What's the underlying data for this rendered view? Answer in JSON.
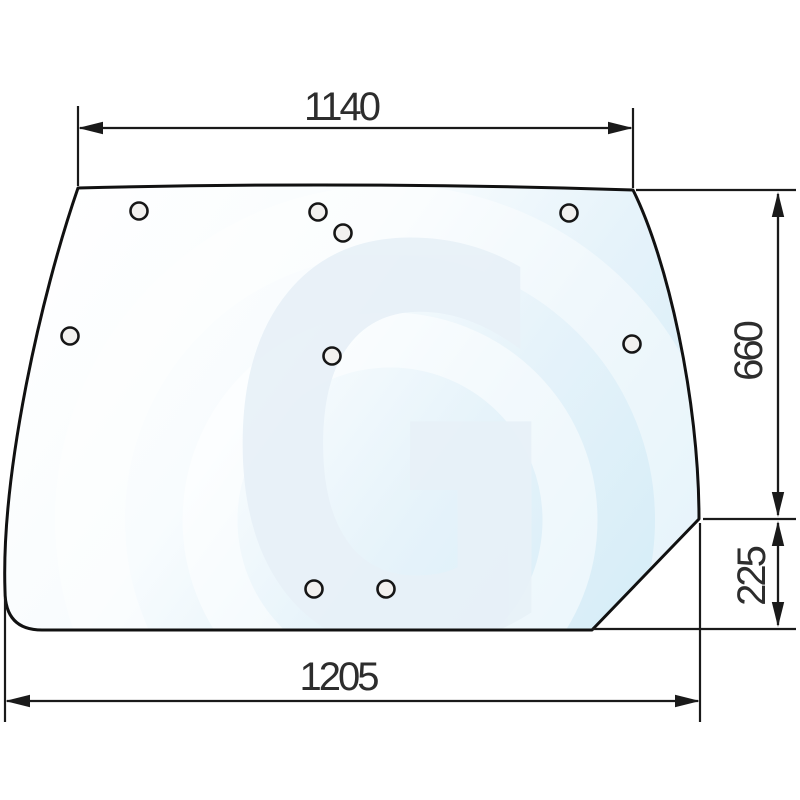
{
  "diagram": {
    "type": "technical-drawing",
    "subject": "curved glass panel with mounting holes",
    "watermark": {
      "letter": "G"
    },
    "dimensions": {
      "top_width": "1140",
      "right_upper_height": "660",
      "right_lower_height": "225",
      "bottom_width": "1205"
    },
    "holes": {
      "count": 9,
      "positions": [
        [
          139,
          211
        ],
        [
          318,
          212
        ],
        [
          343,
          233
        ],
        [
          569,
          213
        ],
        [
          70,
          336
        ],
        [
          332,
          356
        ],
        [
          632,
          344
        ],
        [
          314,
          589
        ],
        [
          386,
          589
        ]
      ]
    },
    "colors": {
      "line": "#1a1a1a",
      "text": "#2d2d2d",
      "glass_tint_light": "#ffffff",
      "glass_tint_deep": "#d3ebf7",
      "watermark": "#e8f1f8"
    }
  }
}
